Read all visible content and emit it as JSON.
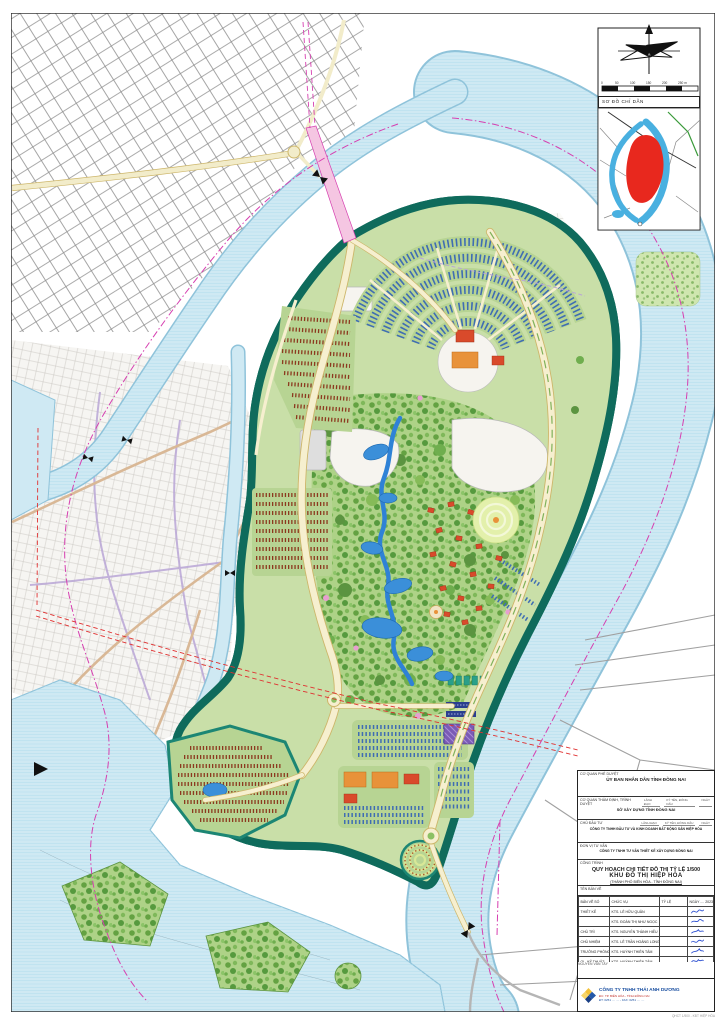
{
  "inset": {
    "title": "SƠ ĐỒ CHỈ DẪN"
  },
  "scale_bar": {
    "labels": [
      "0",
      "50",
      "100",
      "150",
      "200",
      "250 m"
    ]
  },
  "title_block": {
    "approving_label": "CƠ QUAN PHÊ DUYỆT",
    "approving_agency": "ỦY BAN NHÂN DÂN TỈNH ĐỒNG NAI",
    "appraising_label": "CƠ QUAN THẨM ĐỊNH, TRÌNH DUYỆT",
    "appraising_agency": "SỞ XÂY DỰNG TỈNH ĐỒNG NAI",
    "investor_label": "CHỦ ĐẦU TƯ",
    "investor": "CÔNG TY TNHH ĐẦU TƯ VÀ KINH DOANH BẤT ĐỘNG SẢN HIỆP HÒA",
    "consultant_label": "ĐƠN VỊ TƯ VẤN",
    "consultant": "CÔNG TY TNHH TƯ VẤN THIẾT KẾ XÂY DỰNG ĐỒNG NAI",
    "sign_cells": [
      "LÃNH ĐẠO",
      "KÝ TÊN, ĐÓNG DẤU",
      "NGÀY"
    ],
    "project_label": "CÔNG TRÌNH",
    "project_title": "QUY HOẠCH CHI TIẾT ĐÔ THỊ TỶ LỆ 1/500",
    "project_name": "KHU ĐÔ THỊ HIỆP HÒA",
    "project_location": "(THÀNH PHỐ BIÊN HÒA - TỈNH ĐỒNG NAI)",
    "drawing_label": "TÊN BẢN VẼ",
    "table": {
      "headers": [
        "BẢN VẼ SỐ",
        "CHỨC VỤ",
        "TỶ LỆ",
        "NGÀY .... 2023"
      ],
      "rows": [
        {
          "role": "THIẾT KẾ",
          "name": "KTS. LÊ HỮU QUÂN"
        },
        {
          "role": "",
          "name": "KTS. ĐOÀN THỊ NHƯ NGỌC"
        },
        {
          "role": "CHỦ TRÌ",
          "name": "KTS. NGUYỄN THÀNH HIẾU"
        },
        {
          "role": "CHỦ NHIỆM",
          "name": "KTS. LÊ TRẦN HOÀNG LONG"
        },
        {
          "role": "TRƯỞNG PHÒNG",
          "name": "KTS. HUỲNH THIÊN TÂM"
        },
        {
          "role": "QL. KỸ THUẬT",
          "name": "KTS. HUỲNH THIÊN TÂM"
        }
      ]
    },
    "notes_label": "GHI CHÚ",
    "signer": "NGUYỄN VĂN TÂY",
    "company": {
      "name": "CÔNG TY TNHH THÁI ANH DƯƠNG",
      "address": "ĐC: TP. BIÊN HÒA - TỈNH ĐỒNG NAI",
      "phone": "ĐT: 0251 .... ....  -  FAX: 0251 .... ...."
    },
    "print_note": "QHCT 1/500 - KĐT HIỆP HÒA"
  },
  "palette": {
    "river": "#cfe9f3",
    "river_edge": "#8fc3da",
    "island_base": "#c9dfa8",
    "shore_band": "#1c8674",
    "road_fill": "#f6efcf",
    "road_edge": "#cdb66a",
    "roof_blue": "#3f6db3",
    "roof_maroon": "#8c3a1f",
    "building_red": "#d94a2b",
    "building_orange": "#e8923a",
    "park_tree": "#5b9440",
    "lake_blue": "#3b8fd9",
    "boundary_magenta": "#d63fb0",
    "power_red": "#e03030",
    "purple_block": "#7a5bb5",
    "site_red_inset": "#e8281e",
    "company_blue": "#1a4fa0",
    "company_red": "#c03028"
  }
}
